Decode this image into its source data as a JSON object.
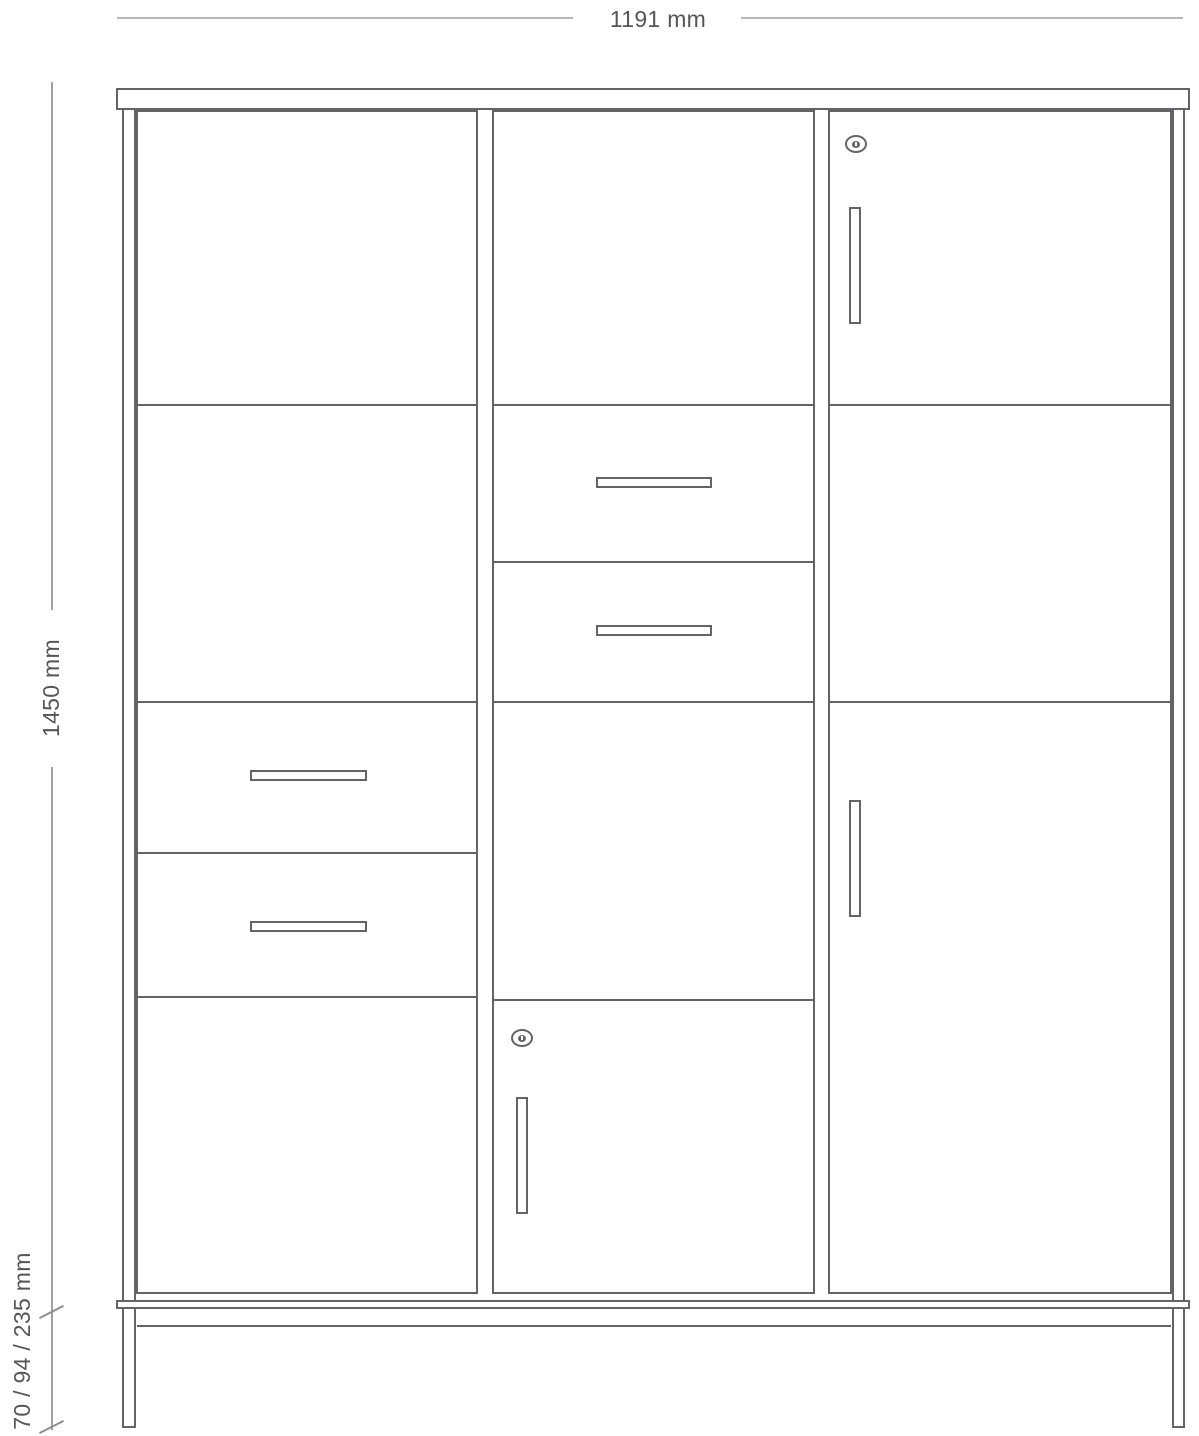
{
  "annotations": {
    "width_label": "1191 mm",
    "height_label": "1450 mm",
    "base_label": "70 / 94 / 235 mm"
  },
  "colors": {
    "outline": "#646467",
    "dimension_line_light": "#b6b8b9",
    "dimension_line_dark": "#a0a0a2",
    "tick": "#8e8e90",
    "text": "#565658",
    "background": "#ffffff"
  },
  "diagram": {
    "title": "cabinet-front-elevation",
    "parts": [
      {
        "name": "left-side-panel",
        "kind": "side",
        "x": 122,
        "y": 110,
        "w": 14,
        "h": 1199
      },
      {
        "name": "right-side-panel",
        "kind": "side",
        "x": 1172,
        "y": 110,
        "w": 13,
        "h": 1199
      },
      {
        "name": "left-leg",
        "kind": "leg",
        "x": 122,
        "y": 1309,
        "w": 14,
        "h": 119
      },
      {
        "name": "right-leg",
        "kind": "leg",
        "x": 1172,
        "y": 1309,
        "w": 13,
        "h": 119
      },
      {
        "name": "top-board",
        "kind": "board",
        "x": 116,
        "y": 88,
        "w": 1074,
        "h": 22
      },
      {
        "name": "bottom-board",
        "kind": "board",
        "x": 116,
        "y": 1300,
        "w": 1074,
        "h": 9
      },
      {
        "name": "base-rail",
        "kind": "line-h",
        "x": 137,
        "y": 1325,
        "w": 1034,
        "h": 2
      },
      {
        "name": "left-column",
        "kind": "column",
        "x": 136,
        "y": 110,
        "w": 342,
        "h": 1184
      },
      {
        "name": "middle-column",
        "kind": "column",
        "x": 492,
        "y": 110,
        "w": 323,
        "h": 1184
      },
      {
        "name": "right-column",
        "kind": "column",
        "x": 828,
        "y": 110,
        "w": 344,
        "h": 1184
      },
      {
        "name": "left-column-shelf-line",
        "kind": "line-h",
        "x": 136,
        "y": 404,
        "w": 342,
        "h": 2
      },
      {
        "name": "left-drawer-1-top-line",
        "kind": "line-h",
        "x": 136,
        "y": 701,
        "w": 342,
        "h": 2
      },
      {
        "name": "left-drawer-2-top-line",
        "kind": "line-h",
        "x": 136,
        "y": 852,
        "w": 342,
        "h": 2
      },
      {
        "name": "left-door-top-line",
        "kind": "line-h",
        "x": 136,
        "y": 996,
        "w": 342,
        "h": 2
      },
      {
        "name": "middle-drawer-1-top-line",
        "kind": "line-h",
        "x": 492,
        "y": 404,
        "w": 323,
        "h": 2
      },
      {
        "name": "middle-drawer-2-top-line",
        "kind": "line-h",
        "x": 492,
        "y": 561,
        "w": 323,
        "h": 2
      },
      {
        "name": "middle-shelf-line",
        "kind": "line-h",
        "x": 492,
        "y": 701,
        "w": 323,
        "h": 2
      },
      {
        "name": "middle-door-top-line",
        "kind": "line-h",
        "x": 492,
        "y": 999,
        "w": 323,
        "h": 2
      },
      {
        "name": "right-top-door-bottom-line",
        "kind": "line-h",
        "x": 828,
        "y": 404,
        "w": 344,
        "h": 2
      },
      {
        "name": "right-door-top-line",
        "kind": "line-h",
        "x": 828,
        "y": 701,
        "w": 344,
        "h": 2
      },
      {
        "name": "left-drawer-1-handle",
        "kind": "handle",
        "x": 250,
        "y": 770,
        "w": 117,
        "h": 11
      },
      {
        "name": "left-drawer-2-handle",
        "kind": "handle",
        "x": 250,
        "y": 921,
        "w": 117,
        "h": 11
      },
      {
        "name": "middle-drawer-1-handle",
        "kind": "handle",
        "x": 596,
        "y": 477,
        "w": 116,
        "h": 11
      },
      {
        "name": "middle-drawer-2-handle",
        "kind": "handle",
        "x": 596,
        "y": 625,
        "w": 116,
        "h": 11
      },
      {
        "name": "right-top-door-handle",
        "kind": "handle",
        "x": 849,
        "y": 207,
        "w": 12,
        "h": 117
      },
      {
        "name": "right-bottom-door-handle",
        "kind": "handle",
        "x": 849,
        "y": 800,
        "w": 12,
        "h": 117
      },
      {
        "name": "middle-door-handle",
        "kind": "handle",
        "x": 516,
        "y": 1097,
        "w": 12,
        "h": 117
      },
      {
        "name": "right-top-door-lock",
        "kind": "lock",
        "x": 845,
        "y": 135,
        "w": 22,
        "h": 18
      },
      {
        "name": "middle-door-lock",
        "kind": "lock",
        "x": 511,
        "y": 1029,
        "w": 22,
        "h": 18
      }
    ]
  }
}
